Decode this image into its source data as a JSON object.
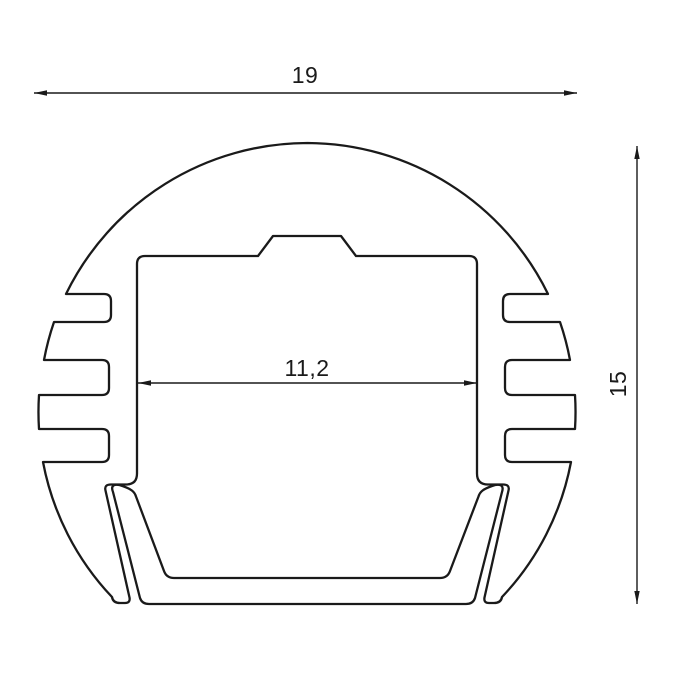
{
  "drawing": {
    "colors": {
      "line": "#1a1a1a",
      "background": "#ffffff"
    },
    "dimensions": {
      "outer_width": {
        "label": "19"
      },
      "overall_height": {
        "label": "15"
      },
      "inner_width": {
        "label": "11,2"
      }
    }
  }
}
